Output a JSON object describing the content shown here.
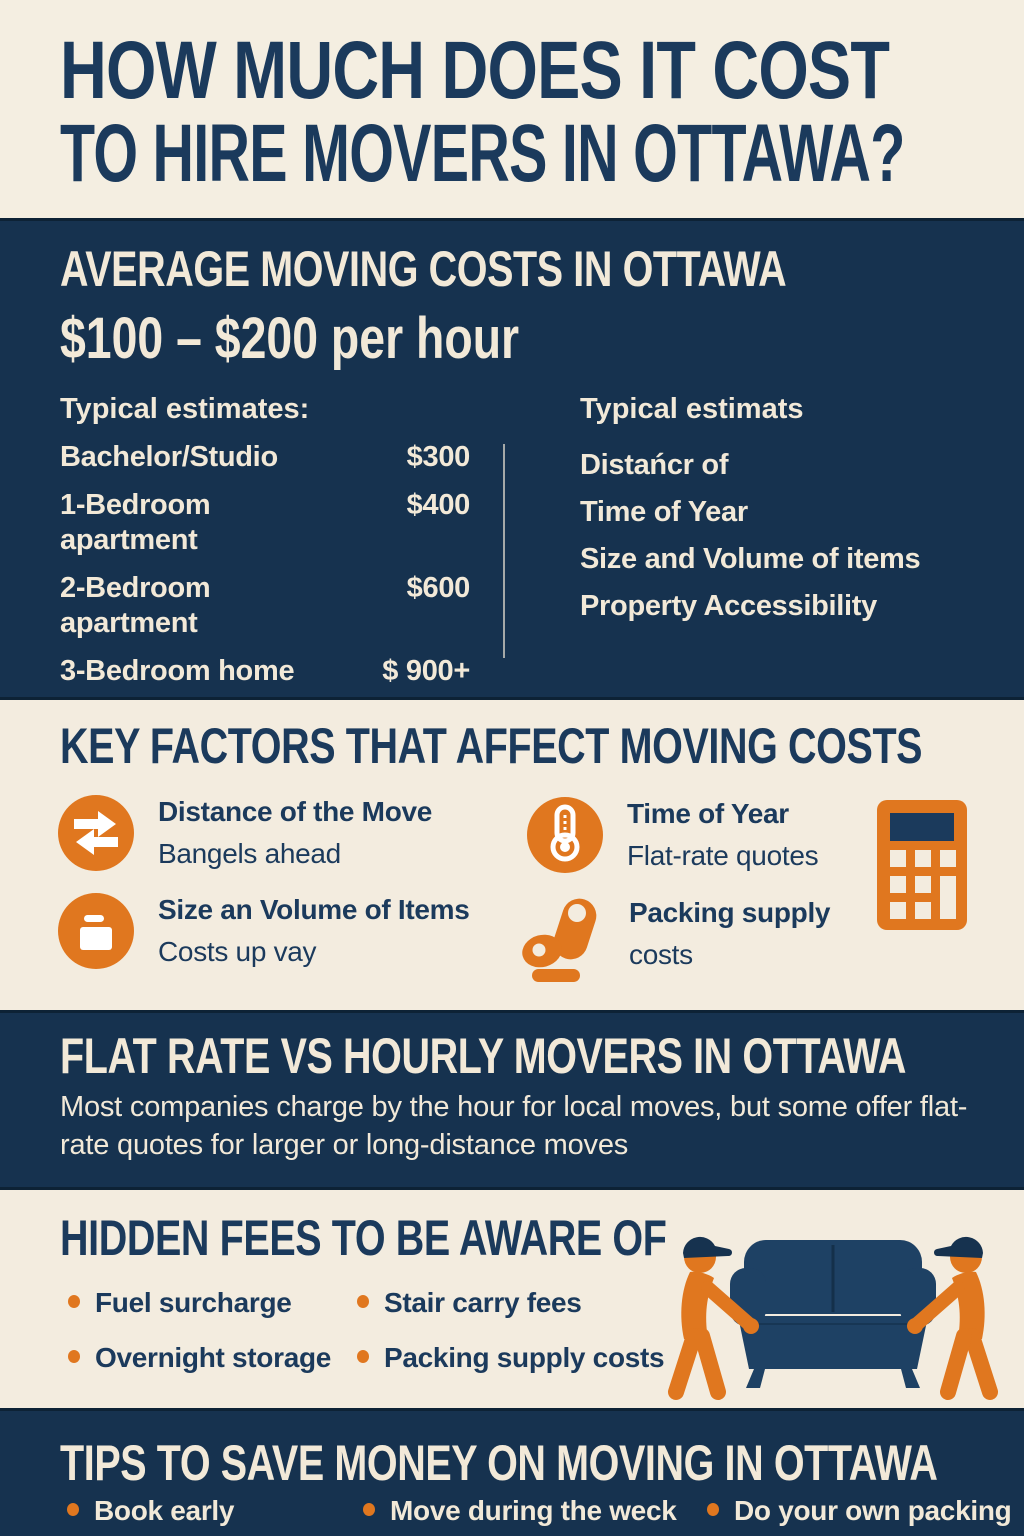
{
  "colors": {
    "navy": "#16324f",
    "cream": "#f3ecdf",
    "orange": "#e0771f",
    "cream_text": "#f2e9d8",
    "couch_navy": "#1e4164"
  },
  "title": {
    "line1": "HOW MUCH DOES IT COST",
    "line2": "TO HIRE MOVERS IN OTTAWA?"
  },
  "average_costs": {
    "heading": "AVERAGE MOVING COSTS IN OTTAWA",
    "rate": "$100 – $200 per hour",
    "estimates_heading": "Typical estimates:",
    "estimates": [
      {
        "label": "Bachelor/Studio",
        "price": "$300"
      },
      {
        "label": "1-Bedroom apartment",
        "price": "$400"
      },
      {
        "label": "2-Bedroom apartment",
        "price": "$600"
      },
      {
        "label": "3-Bedroom home",
        "price": "$ 900+"
      },
      {
        "label": "4+ Bedroom home",
        "price": "$ 1,500–"
      }
    ],
    "factors_heading": "Typical estimats",
    "factors": [
      "Distańcr of",
      "Time of Year",
      "Size and Volume of items",
      "Property Accessibility"
    ]
  },
  "key_factors": {
    "heading": "KEY FACTORS THAT AFFECT MOVING COSTS",
    "items": [
      {
        "icon": "transfer-arrows-icon",
        "title": "Distance of the Move",
        "subtitle": "Bangels ahead"
      },
      {
        "icon": "thermometer-icon",
        "title": "Time of Year",
        "subtitle": "Flat-rate quotes"
      },
      {
        "icon": "moving-box-icon",
        "title": "Size an Volume of Items",
        "subtitle": "Costs up vay"
      },
      {
        "icon": "packing-tape-icon",
        "title": "Packing supply",
        "subtitle": "costs"
      }
    ]
  },
  "flat_rate": {
    "heading": "FLAT RATE VS HOURLY MOVERS IN OTTAWA",
    "body": "Most companies charge by the hour for local moves, but some offer flat-rate quotes for larger or long-distance moves"
  },
  "hidden_fees": {
    "heading": "HIDDEN FEES TO BE AWARE OF",
    "items": [
      "Fuel surcharge",
      "Stair carry fees",
      "Overnight storage",
      "Packing supply costs"
    ]
  },
  "tips": {
    "heading": "TIPS TO SAVE MONEY ON MOVING IN OTTAWA",
    "items": [
      "Book early",
      "Move during the weck",
      "Do your own packing"
    ]
  }
}
